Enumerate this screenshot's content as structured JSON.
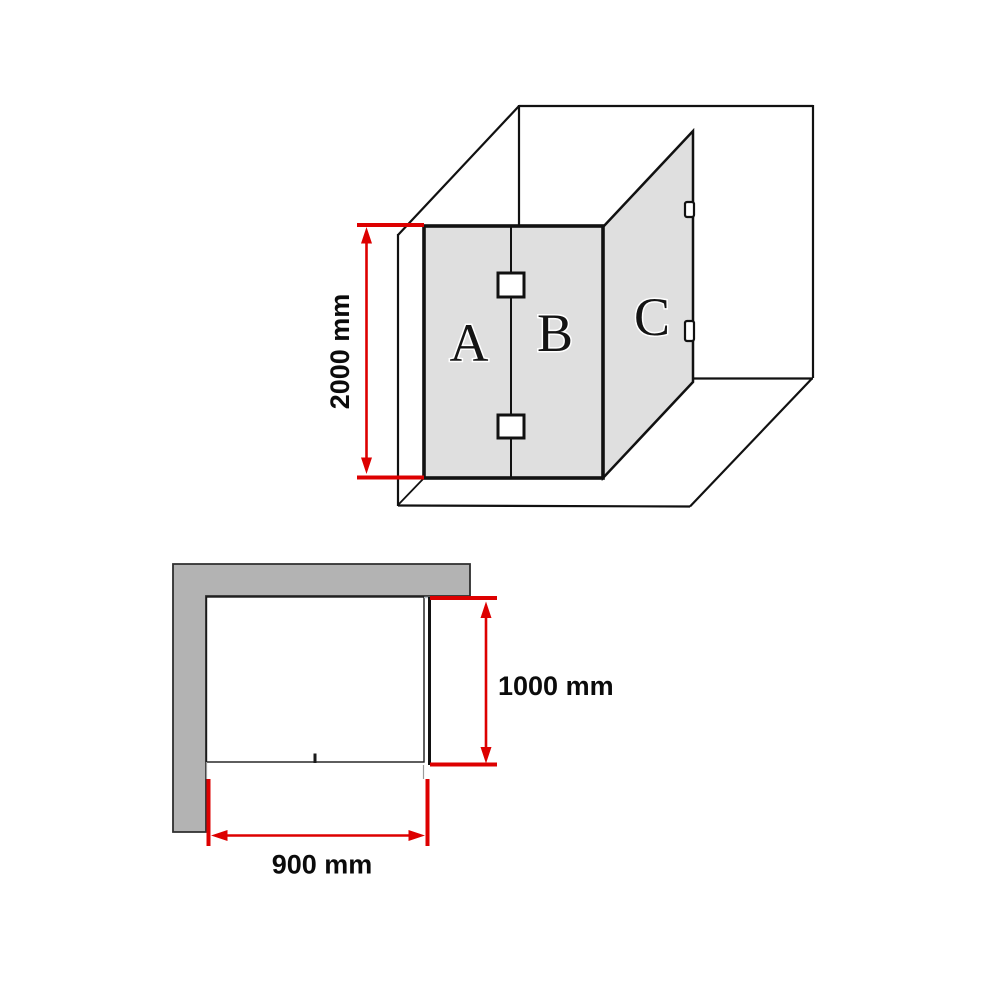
{
  "colors": {
    "dimension-red": "#dd0000",
    "wall-gray": "#b3b3b3",
    "glass-gray": "#dfdfdf",
    "line-black": "#111111"
  },
  "isometric_view": {
    "panels": {
      "a": "A",
      "b": "B",
      "c": "C"
    },
    "height_dimension_label": "2000 mm"
  },
  "plan_view": {
    "depth_dimension_label": "1000 mm",
    "width_dimension_label": "900 mm"
  }
}
